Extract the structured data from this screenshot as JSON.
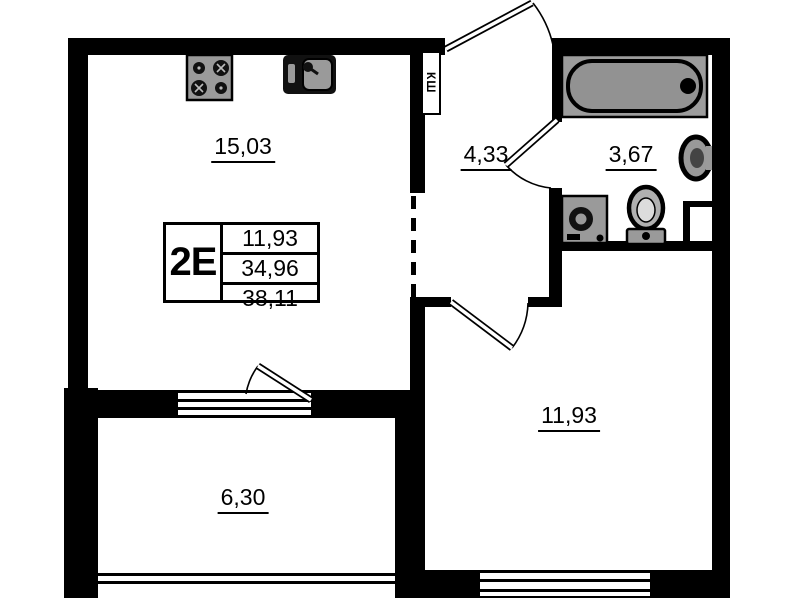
{
  "plan": {
    "title": "apartment floor plan",
    "type_label": "2Е",
    "area_summary": {
      "living": "11,93",
      "subtotal": "34,96",
      "total": "38,11"
    },
    "rooms": [
      {
        "id": "kitchen-living",
        "area": "15,03"
      },
      {
        "id": "hallway",
        "area": "4,33"
      },
      {
        "id": "bathroom",
        "area": "3,67"
      },
      {
        "id": "bedroom",
        "area": "11,93"
      },
      {
        "id": "balcony",
        "area": "6,30"
      }
    ],
    "labels": {
      "duct": "КШ"
    },
    "fixtures": [
      "stove-icon",
      "kitchen-sink-icon",
      "bathtub-icon",
      "washbasin-icon",
      "toilet-icon",
      "washing-machine-icon"
    ],
    "colors": {
      "wall": "#000000",
      "background": "#ffffff",
      "fixture_gray": "#9a9a9a",
      "fixture_gray_dark": "#8f8f8f"
    }
  }
}
